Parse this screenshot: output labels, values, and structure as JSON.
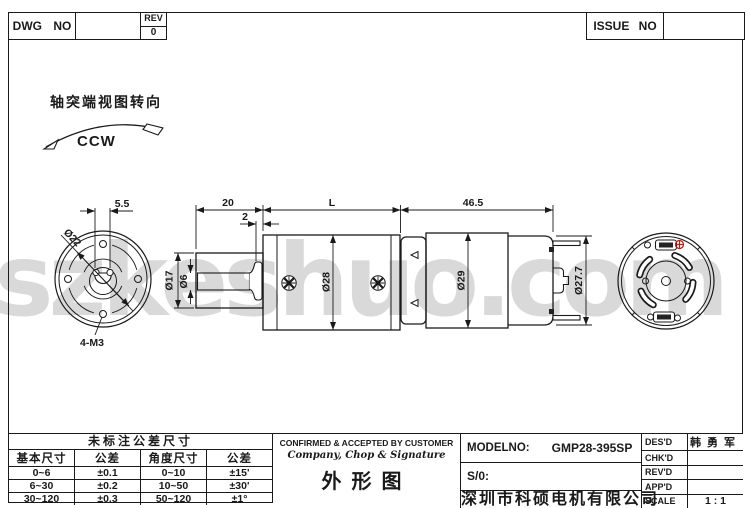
{
  "header": {
    "dwg_label": "DWG NO",
    "dwg_value": "",
    "rev_label": "REV",
    "rev_value": "0",
    "issue_label": "ISSUE NO",
    "issue_value": ""
  },
  "view_note": {
    "label": "轴突端视图转向",
    "direction": "CCW"
  },
  "watermark": "szkeshuo.com",
  "dims": {
    "flat_width": "5.5",
    "front_dia": "Ø22",
    "mount_holes": "4-M3",
    "shaft_len": "20",
    "washer": "2",
    "gearbox_len": "L",
    "motor_len": "46.5",
    "boss_dia": "Ø17",
    "shaft_dia": "Ø6",
    "gearbox_dia": "Ø28",
    "motor_dia": "Ø29",
    "cap_dia": "Ø27.7"
  },
  "tol_table": {
    "title": "未标注公差尺寸",
    "col_headers": [
      "基本尺寸",
      "公差",
      "角度尺寸",
      "公差"
    ],
    "rows": [
      [
        "0~6",
        "±0.1",
        "0~10",
        "±15'"
      ],
      [
        "6~30",
        "±0.2",
        "10~50",
        "±30'"
      ],
      [
        "30~120",
        "±0.3",
        "50~120",
        "±1°"
      ]
    ]
  },
  "confirm_block": {
    "line1": "CONFIRMED & ACCEPTED BY CUSTOMER",
    "line2": "Company, Chop & Signature",
    "drawing_title": "外形图"
  },
  "title_block": {
    "model_label": "MODELNO:",
    "model_value": "GMP28-395SP",
    "so_label": "S/0:",
    "company": "深圳市科硕电机有限公司",
    "rows": [
      {
        "label": "DES'D",
        "value": "韩勇军"
      },
      {
        "label": "CHK'D",
        "value": ""
      },
      {
        "label": "REV'D",
        "value": ""
      },
      {
        "label": "APP'D",
        "value": ""
      },
      {
        "label": "SCALE",
        "value": "1 : 1"
      }
    ]
  },
  "colors": {
    "line": "#1a1a1a",
    "positive_terminal_red": "#cc1111",
    "watermark_gray": "#d9d9d9"
  }
}
